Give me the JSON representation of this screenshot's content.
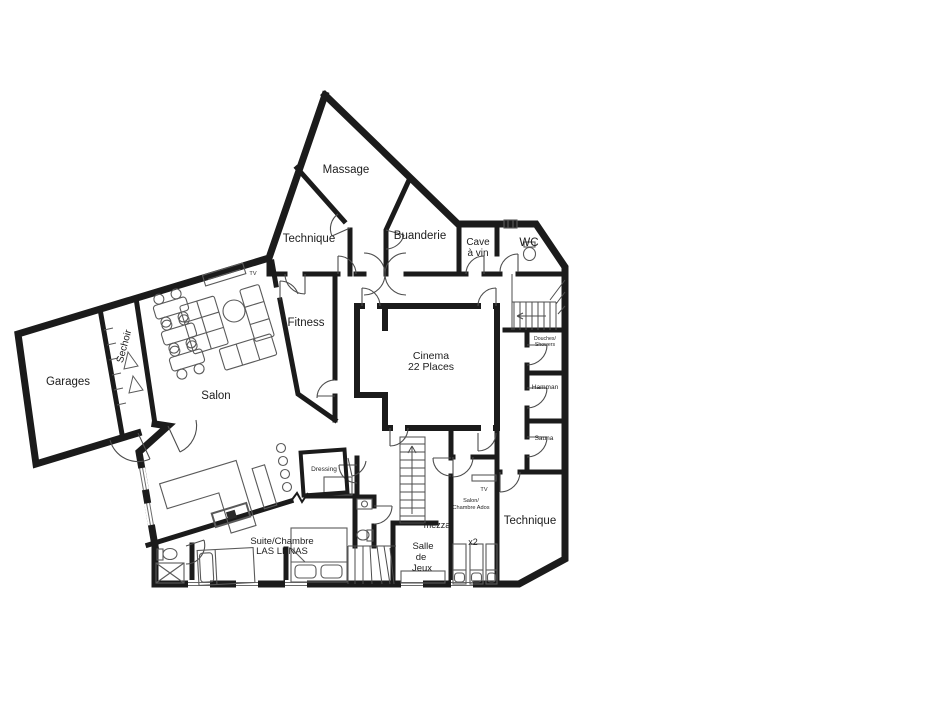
{
  "plan": {
    "type": "architectural floor plan",
    "colors": {
      "walls": "#1b1b1b",
      "thin_lines": "#4d4d4d",
      "text": "#1d1d1d",
      "background": "#ffffff"
    },
    "labels": {
      "massage": "Massage",
      "technique_top": "Technique",
      "buanderie": "Buanderie",
      "cave_line1": "Cave",
      "cave_line2": "à vin",
      "wc": "WC",
      "fitness": "Fitness",
      "cinema_line1": "Cinema",
      "cinema_line2": "22 Places",
      "garages": "Garages",
      "sechoir": "Sechoir",
      "salon": "Salon",
      "tv_salon": "TV",
      "dressing": "Dressing",
      "douches_line1": "Douches/",
      "douches_line2": "Showers",
      "hamman": "Hamman",
      "sauna": "Sauna",
      "suite_line1": "Suite/Chambre",
      "suite_line2": "LAS LENAS",
      "mezza": "mezza",
      "salle_line1": "Salle",
      "salle_line2": "de",
      "salle_line3": "Jeux",
      "tv_ados": "TV",
      "ados_line1": "Salon/",
      "ados_line2": "Chambre Ados",
      "x2": "x2",
      "technique_bottom": "Technique"
    }
  }
}
